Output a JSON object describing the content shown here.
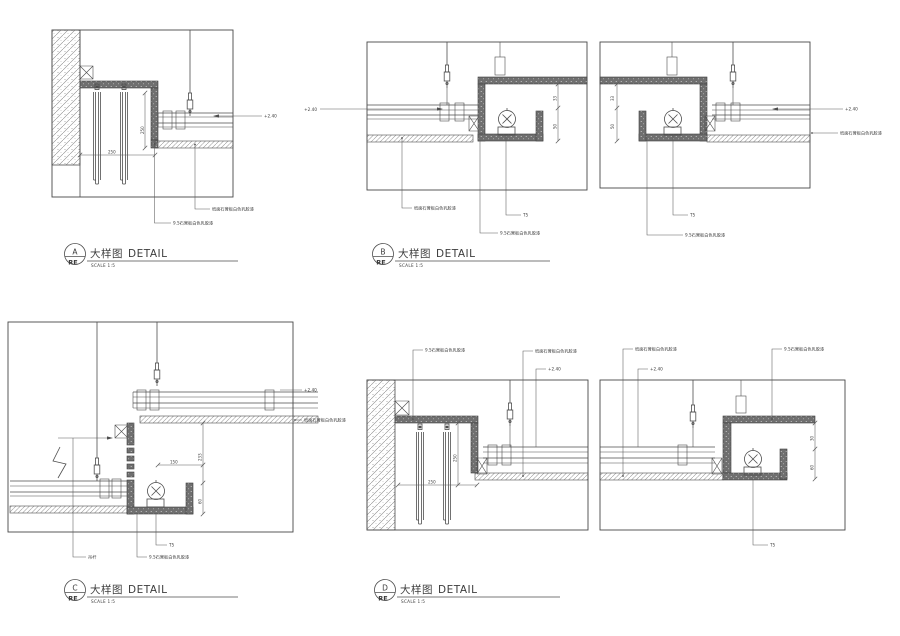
{
  "colors": {
    "line": "#4d4d4d",
    "dark_board": "#6f6f6f",
    "text": "#3c3c3c",
    "background": "#ffffff"
  },
  "labels": {
    "detail_cn": "大样图",
    "detail_en": "DETAIL",
    "scale": "SCALE  1:5",
    "ref": "RE"
  },
  "details": {
    "a": {
      "letter": "A"
    },
    "b": {
      "letter": "B"
    },
    "c": {
      "letter": "C"
    },
    "d": {
      "letter": "D"
    }
  },
  "callouts": {
    "flat_board": "纸面石膏板白色乳胶漆",
    "cove_board": "9.5石膏板白色乳胶漆",
    "lamp": "T5",
    "hanger_rod": "吊杆",
    "level": "+2.40"
  },
  "dimensions": {
    "a": {
      "vertical": "250",
      "horizontal": "250"
    },
    "b": {
      "upper": "33",
      "lower": "50"
    },
    "c": {
      "upper": "233",
      "lower": "60",
      "horizontal": "150"
    },
    "d_left": {
      "vertical": "250",
      "horizontal": "250"
    },
    "d_right": {
      "upper": "30",
      "lower": "60"
    }
  }
}
